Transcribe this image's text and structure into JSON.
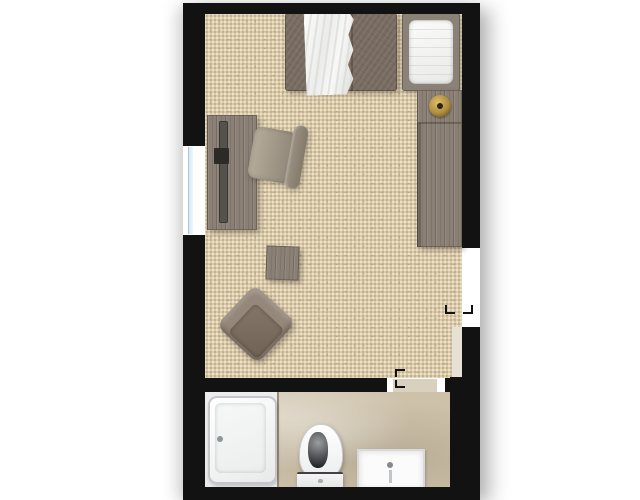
{
  "app": {
    "type": "floor-plan-viewer",
    "title": "Studio apartment floor plan (top-down 2D view)"
  },
  "floorplan": {
    "view": "top-down-2d",
    "rooms": [
      {
        "id": "bedroom",
        "label": "Bedroom / living area",
        "floor": "woven beige carpet",
        "furniture": [
          "double bed with white duvet",
          "cot with white mattress",
          "nightstand with brass knob lamp",
          "tall wardrobe",
          "desk with laptop",
          "desk chair",
          "wooden ottoman",
          "armchair rotated 45 degrees"
        ]
      },
      {
        "id": "bathroom",
        "label": "Bathroom",
        "floor": "beige stone tile",
        "fixtures": [
          "bathtub in white alcove",
          "toilet",
          "washbasin with faucet"
        ]
      }
    ],
    "openings": [
      {
        "id": "window",
        "wall": "left",
        "type": "window"
      },
      {
        "id": "entry-door",
        "wall": "right",
        "type": "doorway with jamb marks"
      },
      {
        "id": "bathroom-door",
        "wall": "bedroom-bathroom divider",
        "type": "doorway with jamb marks"
      }
    ],
    "colors": {
      "wall": "#121212",
      "carpet": "#dacbad",
      "carpet_dot_dark": "#c2ae8a",
      "carpet_dot_light": "#efe4c9",
      "wood": "#8b8076",
      "bed": "#776a5f",
      "blanket": "#f4f4f2",
      "brass": "#b08d3e",
      "stone_floor": "#cdc1aa",
      "tub_alcove": "#e9e9ec",
      "fixture_white": "#fbfbfb",
      "window_glass": "#d7e9f4",
      "background": "#ffffff"
    }
  }
}
